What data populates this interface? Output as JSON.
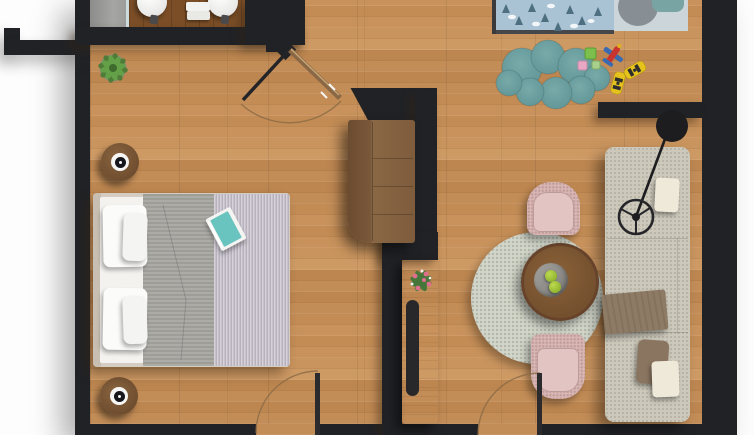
{
  "app": {
    "description": "Top-down 3D rendered apartment floor plan with bedroom, bathroom, entry hall, kids corner and living room",
    "canvas": {
      "width": 754,
      "height": 435
    }
  },
  "colors": {
    "wall": "#212226",
    "floor_wood": "#c78f57",
    "vanity_wood": "#7b4e27",
    "shower_tile": "#9a9a98",
    "bed_blanket_grey": "#a7a6a1",
    "bed_duvet_lavender": "#c6bfcb",
    "sofa_beige": "#ccc8bb",
    "armchair_pink": "#d7b6b4",
    "round_rug": "#d2d6ca",
    "cloud_rug_teal": "#6ba0a2",
    "kids_duvet_blue": "#a9c3d4",
    "apple_green": "#9ec43a",
    "toy_taxi_yellow": "#e6c31c",
    "toy_plane_red": "#c8352f"
  },
  "labels": {
    "apartment": "Apartment floor plan",
    "bathroom": "Bathroom with vanity and twin sinks",
    "shower": "Shower floor",
    "sink": "Round washbasin",
    "towels": "Folded towels",
    "bedroom": "Bedroom",
    "double_bed": "Double bed with grey blanket and striped lavender duvet",
    "pillow": "White pillow",
    "book": "Book on bed",
    "nightstand": "Round nightstand with lamp",
    "plant": "Potted plant",
    "hallway": "Entry hall",
    "front_door": "Open front door with swing arc",
    "wardrobe": "Hall wardrobe cabinet",
    "console": "TV console with decorative tray",
    "console_plant": "Flowering plant on console",
    "kids_room": "Kids corner",
    "kids_bed": "Kids bed with forest-pattern duvet",
    "cloud_rug": "Cloud-shaped teal play rug",
    "toys": "Toy plane, taxis and blocks",
    "living_room": "Living room",
    "sofa": "Beige sofa with cushions and throw",
    "floor_lamp": "Black arc floor lamp",
    "round_rug": "Round speckled rug",
    "coffee_table": "Round coffee table with bowl of apples",
    "armchair": "Pink armchair",
    "interior_door": "Interior door with swing arc"
  },
  "rooms": [
    {
      "name": "bathroom",
      "items": [
        "shower floor",
        "glass partition",
        "wood vanity",
        "two round sinks",
        "folded towels"
      ]
    },
    {
      "name": "bedroom",
      "items": [
        "double bed",
        "four pillows",
        "grey blanket",
        "striped duvet",
        "book",
        "two nightstands with lamps",
        "potted plant",
        "door"
      ]
    },
    {
      "name": "entry-hall",
      "items": [
        "open front door",
        "door swing arc",
        "wardrobe cabinet"
      ]
    },
    {
      "name": "kids-corner",
      "items": [
        "kids bed",
        "cloud rug",
        "toy plane",
        "two yellow taxis",
        "toy blocks"
      ]
    },
    {
      "name": "living-room",
      "items": [
        "sofa",
        "throw blanket",
        "cushions",
        "arc floor lamp",
        "round rug",
        "coffee table",
        "green apples",
        "two pink armchairs",
        "TV console",
        "flower plant",
        "door"
      ]
    }
  ]
}
